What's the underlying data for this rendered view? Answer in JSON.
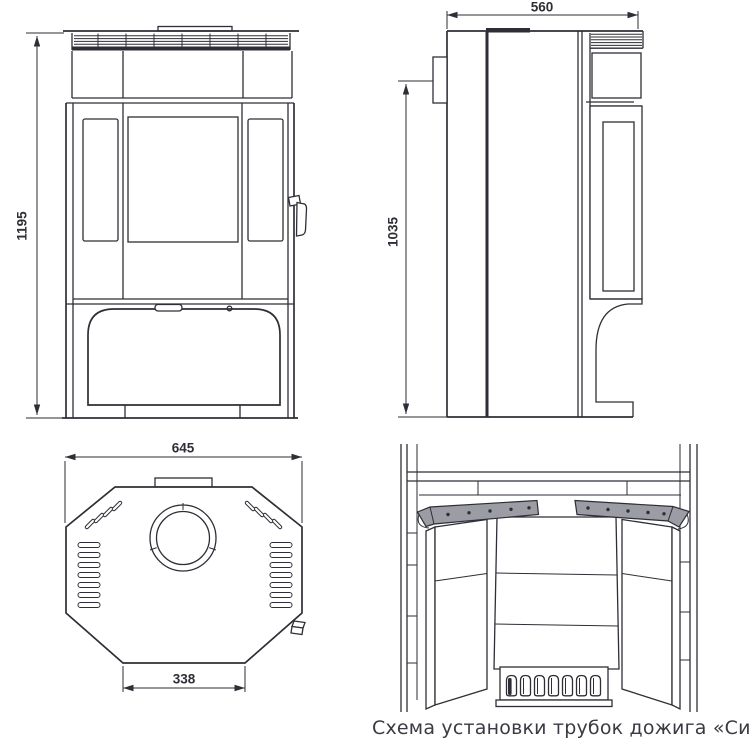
{
  "caption": "Схема установки трубок дожига «Сибирь-12»",
  "dimensions": {
    "front_height": "1195",
    "depth": "560",
    "flue_height": "1035",
    "top_width": "645",
    "front_width": "338"
  },
  "colors": {
    "line": "#2e2e36",
    "tube_fill": "#9c9ca4",
    "caption_text": "#3a3a42",
    "background": "#ffffff"
  }
}
